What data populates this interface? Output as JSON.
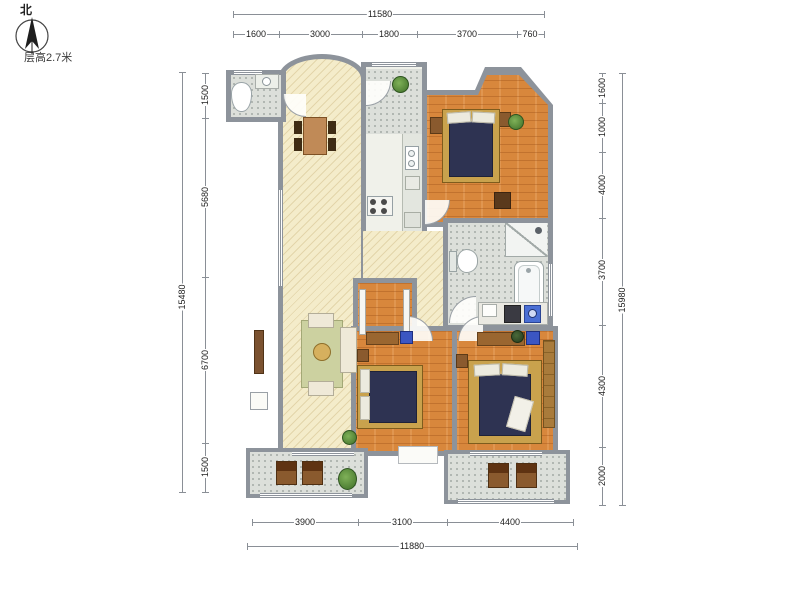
{
  "annotations": {
    "north_label": "北",
    "floor_height_note": "层高2.7米"
  },
  "dimensions": {
    "top": {
      "total": "11580",
      "segments": [
        "1600",
        "3000",
        "1800",
        "3700",
        "760"
      ]
    },
    "bottom": {
      "total": "11880",
      "segments": [
        "3900",
        "3100",
        "4400"
      ]
    },
    "left": {
      "total": "15480",
      "segments": [
        "1500",
        "5680",
        "6700",
        "1500"
      ]
    },
    "right": {
      "total": "15980",
      "segments": [
        "1600",
        "1000",
        "4000",
        "3700",
        "4300",
        "2000"
      ]
    }
  },
  "colors": {
    "wall": "#8d939b",
    "floor_living_cream": "#f4ecca",
    "floor_bedroom_wood": "#d8873c",
    "floor_tile_gray": "#dcdfda",
    "bed_mattress_navy": "#2e3352",
    "bed_frame_gold": "#c9a24d",
    "washer_blue": "#4a6fd4",
    "dimension_line": "#8a8f96"
  }
}
